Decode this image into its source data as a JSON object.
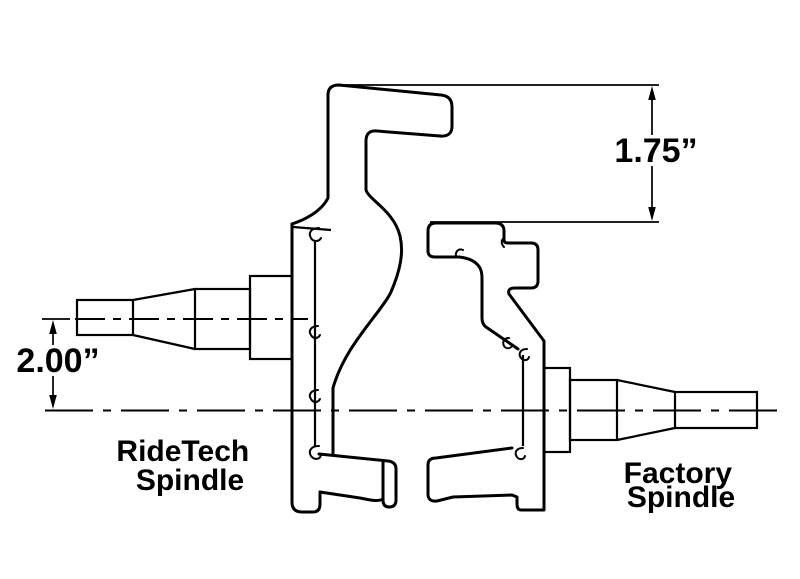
{
  "colors": {
    "background": "#ffffff",
    "ink": "#000000"
  },
  "dimensions": {
    "arm_height": "1.75”",
    "drop_height": "2.00”"
  },
  "labels": {
    "ridetech": {
      "line1": "RideTech",
      "line2": "Spindle"
    },
    "factory": {
      "line1": "Factory",
      "line2": "Spindle"
    }
  }
}
